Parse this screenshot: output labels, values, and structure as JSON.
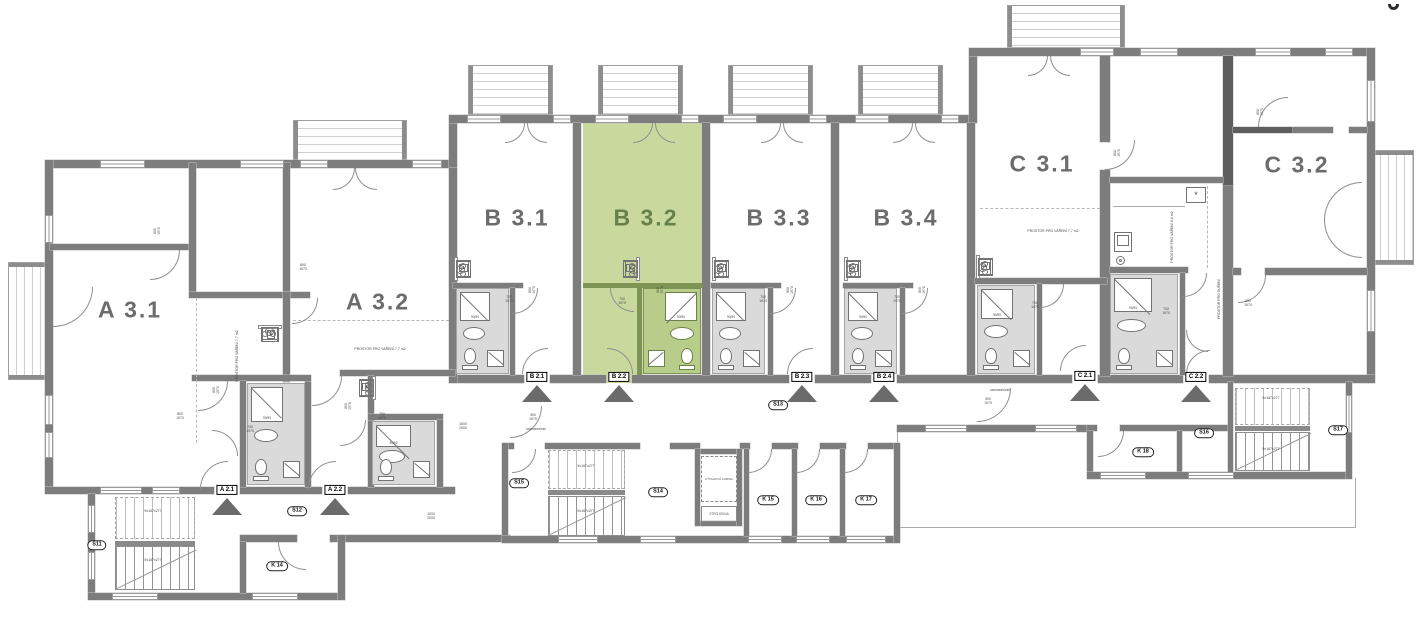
{
  "document": {
    "type": "floor-plan",
    "highlighted_unit": "B 3.2"
  },
  "colors": {
    "wall": "#7d7d7d",
    "wall_dark": "#5e5e5e",
    "highlight_fill": "#c9d99d",
    "highlight_fill_dark": "#b9cd8a",
    "highlight_wall": "#7e9455",
    "highlight_text": "#68814a",
    "label_text": "#6c6c6c",
    "bath_floor": "#dadada",
    "triangle": "#6b6b6b"
  },
  "apartments": [
    {
      "id": "A3.1",
      "label": "A 3.1",
      "x": 130,
      "y": 310,
      "highlighted": false
    },
    {
      "id": "A3.2",
      "label": "A 3.2",
      "x": 378,
      "y": 302,
      "highlighted": false
    },
    {
      "id": "B3.1",
      "label": "B 3.1",
      "x": 517,
      "y": 218,
      "highlighted": false
    },
    {
      "id": "B3.2",
      "label": "B 3.2",
      "x": 646,
      "y": 218,
      "highlighted": true
    },
    {
      "id": "B3.3",
      "label": "B 3.3",
      "x": 779,
      "y": 218,
      "highlighted": false
    },
    {
      "id": "B3.4",
      "label": "B 3.4",
      "x": 906,
      "y": 218,
      "highlighted": false
    },
    {
      "id": "C3.1",
      "label": "C 3.1",
      "x": 1042,
      "y": 164,
      "highlighted": false
    },
    {
      "id": "C3.2",
      "label": "C 3.2",
      "x": 1297,
      "y": 165,
      "highlighted": false
    }
  ],
  "unit_entrances": [
    {
      "label": "A 2.1",
      "x": 227,
      "y": 490
    },
    {
      "label": "A 2.2",
      "x": 335,
      "y": 490
    },
    {
      "label": "B 2.1",
      "x": 537,
      "y": 377
    },
    {
      "label": "B 2.2",
      "x": 619,
      "y": 377
    },
    {
      "label": "B 2.3",
      "x": 802,
      "y": 377
    },
    {
      "label": "B 2.4",
      "x": 884,
      "y": 377
    },
    {
      "label": "C 2.1",
      "x": 1085,
      "y": 376
    },
    {
      "label": "C 2.2",
      "x": 1196,
      "y": 377
    }
  ],
  "room_tags": [
    {
      "label": "S11",
      "x": 97,
      "y": 545
    },
    {
      "label": "S12",
      "x": 297,
      "y": 511
    },
    {
      "label": "S13",
      "x": 778,
      "y": 405
    },
    {
      "label": "S14",
      "x": 658,
      "y": 492
    },
    {
      "label": "S15",
      "x": 519,
      "y": 483
    },
    {
      "label": "S16",
      "x": 1204,
      "y": 433
    },
    {
      "label": "S17",
      "x": 1338,
      "y": 430
    },
    {
      "label": "K 14",
      "x": 277,
      "y": 566
    },
    {
      "label": "K 15",
      "x": 768,
      "y": 500
    },
    {
      "label": "K 16",
      "x": 816,
      "y": 500
    },
    {
      "label": "K 17",
      "x": 866,
      "y": 500
    },
    {
      "label": "K 18",
      "x": 1143,
      "y": 452
    }
  ],
  "elevator": {
    "cabin": "VÝTAHOVÁ KABINA",
    "machine_room": "STROJOVNA"
  },
  "shower_label": "90/90",
  "annotations": [
    {
      "text": "700\n1970",
      "x": 509,
      "y": 299
    },
    {
      "text": "700\n1970",
      "x": 622,
      "y": 301
    },
    {
      "text": "700\n1970",
      "x": 763,
      "y": 299
    },
    {
      "text": "700\n1970",
      "x": 897,
      "y": 299
    },
    {
      "text": "700\n1970",
      "x": 1035,
      "y": 305
    },
    {
      "text": "700\n1970",
      "x": 1166,
      "y": 311
    },
    {
      "text": "800\n1970",
      "x": 157,
      "y": 231,
      "rot": 1
    },
    {
      "text": "800\n1970",
      "x": 180,
      "y": 416
    },
    {
      "text": "800\n1970",
      "x": 216,
      "y": 390,
      "rot": 1
    },
    {
      "text": "700\n1970",
      "x": 250,
      "y": 429
    },
    {
      "text": "800\n1970",
      "x": 303,
      "y": 267
    },
    {
      "text": "800\n1970",
      "x": 348,
      "y": 406,
      "rot": 1
    },
    {
      "text": "700\n1970",
      "x": 382,
      "y": 416
    },
    {
      "text": "800\n1970",
      "x": 532,
      "y": 290,
      "rot": 1
    },
    {
      "text": "800\n1970",
      "x": 660,
      "y": 290,
      "rot": 1
    },
    {
      "text": "800\n1970",
      "x": 790,
      "y": 290,
      "rot": 1
    },
    {
      "text": "800\n1970",
      "x": 922,
      "y": 290,
      "rot": 1
    },
    {
      "text": "900\n1970",
      "x": 533,
      "y": 417
    },
    {
      "text": "samozavírač",
      "x": 536,
      "y": 429
    },
    {
      "text": "samozavírač",
      "x": 1000,
      "y": 390
    },
    {
      "text": "900\n1970",
      "x": 988,
      "y": 401
    },
    {
      "text": "1000\n2000",
      "x": 463,
      "y": 426
    },
    {
      "text": "1000\n2000",
      "x": 431,
      "y": 516
    },
    {
      "text": "800\n1970",
      "x": 1117,
      "y": 153,
      "rot": 1
    },
    {
      "text": "800\n1970",
      "x": 1260,
      "y": 112,
      "rot": 1
    },
    {
      "text": "800\n1970",
      "x": 1248,
      "y": 303
    },
    {
      "text": "9x167x277",
      "x": 153,
      "y": 511
    },
    {
      "text": "9x167x277",
      "x": 153,
      "y": 560
    },
    {
      "text": "9x167x277",
      "x": 586,
      "y": 466
    },
    {
      "text": "9x167x277",
      "x": 586,
      "y": 511
    },
    {
      "text": "9x167x277",
      "x": 1271,
      "y": 398
    },
    {
      "text": "9x167x277",
      "x": 1271,
      "y": 449
    },
    {
      "text": "PROSTOR PRO VAŘENÍ 7,7 m2",
      "x": 380,
      "y": 349
    },
    {
      "text": "PROSTOR PRO VAŘENÍ 7,7 m2",
      "x": 1053,
      "y": 231
    },
    {
      "text": "PROSTOR PRO VAŘENÍ 7,7 m2",
      "x": 237,
      "y": 356,
      "rot": 1
    },
    {
      "text": "PROSTOR PRO VAŘENÍ 8,6 m2",
      "x": 1172,
      "y": 237,
      "rot": 1
    },
    {
      "text": "PROSTOR PRO SUŠENÍ",
      "x": 1219,
      "y": 299,
      "rot": 1
    }
  ]
}
